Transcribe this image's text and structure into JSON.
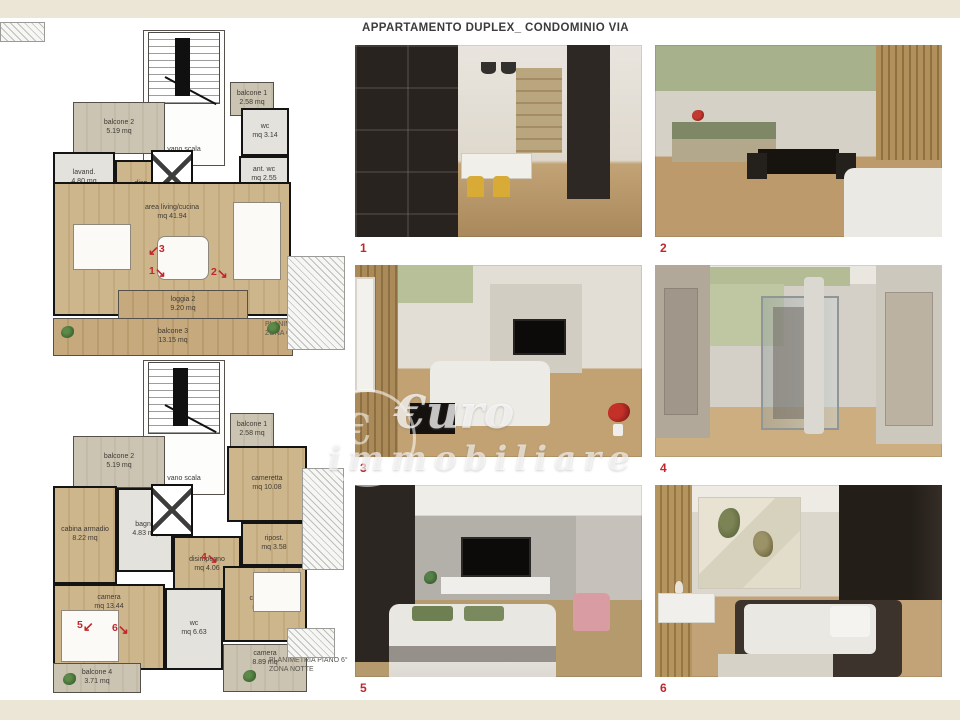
{
  "page": {
    "title": "APPARTAMENTO DUPLEX_ CONDOMINIO VIA",
    "watermark": {
      "line1": "€uro",
      "line2": "immobiliare",
      "symbol": "€"
    },
    "colors": {
      "accent_red": "#c0272d",
      "band_beige": "#ece6d7",
      "wood": "#c9ad82",
      "outdoor_beige": "#c9c2b0",
      "wall_black": "#141414",
      "green_accent": "#b3bc95"
    }
  },
  "plans": {
    "upper": {
      "caption1": "PLANIMETRIA PIANO 7°",
      "caption2": "ZONA GIORNO",
      "rooms": {
        "balcone2": {
          "label": "balcone 2",
          "area": "5.19 mq"
        },
        "vano_scala": {
          "label": "vano scala",
          "area": ""
        },
        "balcone1": {
          "label": "balcone 1",
          "area": "2.58 mq"
        },
        "lavanderia": {
          "label": "lavand.",
          "area": "4.80 mq"
        },
        "dispensa": {
          "label": "disp.",
          "area": "mq 4.44"
        },
        "wc": {
          "label": "wc",
          "area": "mq 3.14"
        },
        "antiwc": {
          "label": "ant. wc",
          "area": "mq 2.55"
        },
        "living": {
          "label": "area living/cucina",
          "area": "mq 41.94"
        },
        "loggia2": {
          "label": "loggia 2",
          "area": "9.20 mq"
        },
        "balcone3": {
          "label": "balcone 3",
          "area": "13.15 mq"
        }
      },
      "markers": {
        "m1": {
          "n": "1",
          "arrow": "↘"
        },
        "m2": {
          "n": "2",
          "arrow": "↘"
        },
        "m3": {
          "n": "3",
          "arrow": "↙"
        }
      }
    },
    "lower": {
      "caption1": "PLANIMETRIA PIANO 6°",
      "caption2": "ZONA NOTTE",
      "rooms": {
        "balcone2": {
          "label": "balcone 2",
          "area": "5.19 mq"
        },
        "vano_scala": {
          "label": "vano scala",
          "area": ""
        },
        "balcone1": {
          "label": "balcone 1",
          "area": "2.58 mq"
        },
        "cameretta1": {
          "label": "cameretta",
          "area": "mq 10.08"
        },
        "cabina": {
          "label": "cabina armadio",
          "area": "8.22 mq"
        },
        "bagno": {
          "label": "bagno",
          "area": "4.83 mq"
        },
        "ripostiglio": {
          "label": "ripost.",
          "area": "mq 3.58"
        },
        "disimpegno": {
          "label": "disimpegno",
          "area": "mq 4.06"
        },
        "camera": {
          "label": "camera",
          "area": "mq 13.44"
        },
        "wc": {
          "label": "wc",
          "area": "mq 6.63"
        },
        "cameretta2": {
          "label": "cameretta",
          "area": "mq 9.87"
        },
        "balcone4": {
          "label": "balcone 4",
          "area": "3.71 mq"
        },
        "camera_est": {
          "label": "camera",
          "area": "8.89 mq"
        }
      },
      "markers": {
        "m4": {
          "n": "4",
          "arrow": "↘"
        },
        "m5": {
          "n": "5",
          "arrow": "↙"
        },
        "m6": {
          "n": "6",
          "arrow": "↘"
        }
      }
    }
  },
  "photos": {
    "p1": {
      "num": "1"
    },
    "p2": {
      "num": "2"
    },
    "p3": {
      "num": "3"
    },
    "p4": {
      "num": "4"
    },
    "p5": {
      "num": "5"
    },
    "p6": {
      "num": "6"
    }
  }
}
